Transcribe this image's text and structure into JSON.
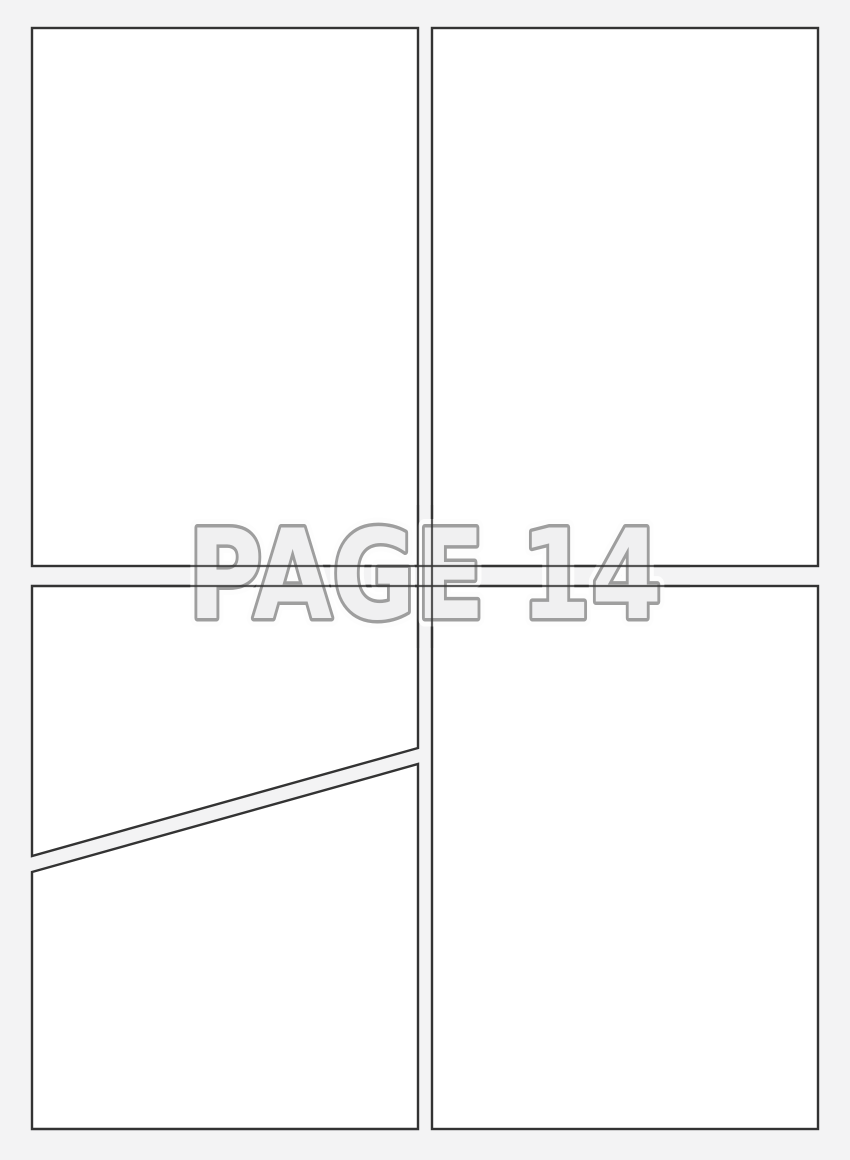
{
  "page": {
    "kind": "blank-comic-page-template",
    "watermark": {
      "text": "PAGE 14"
    },
    "panels": [
      {
        "id": "panel-1",
        "position": "top-left",
        "shape": "rectangle",
        "content": ""
      },
      {
        "id": "panel-2",
        "position": "top-right",
        "shape": "rectangle",
        "content": ""
      },
      {
        "id": "panel-3",
        "position": "bottom-left-upper",
        "shape": "quad-diagonal-bottom",
        "content": ""
      },
      {
        "id": "panel-4",
        "position": "bottom-left-lower",
        "shape": "quad-diagonal-top",
        "content": ""
      },
      {
        "id": "panel-5",
        "position": "bottom-right",
        "shape": "rectangle",
        "content": ""
      }
    ],
    "colors": {
      "background": "#f3f3f4",
      "panel_fill": "#ffffff",
      "panel_border": "#333333",
      "watermark_fill": "#f0f0f1",
      "watermark_outline": "#9e9e9e",
      "watermark_halo": "#fdfdfd"
    }
  }
}
